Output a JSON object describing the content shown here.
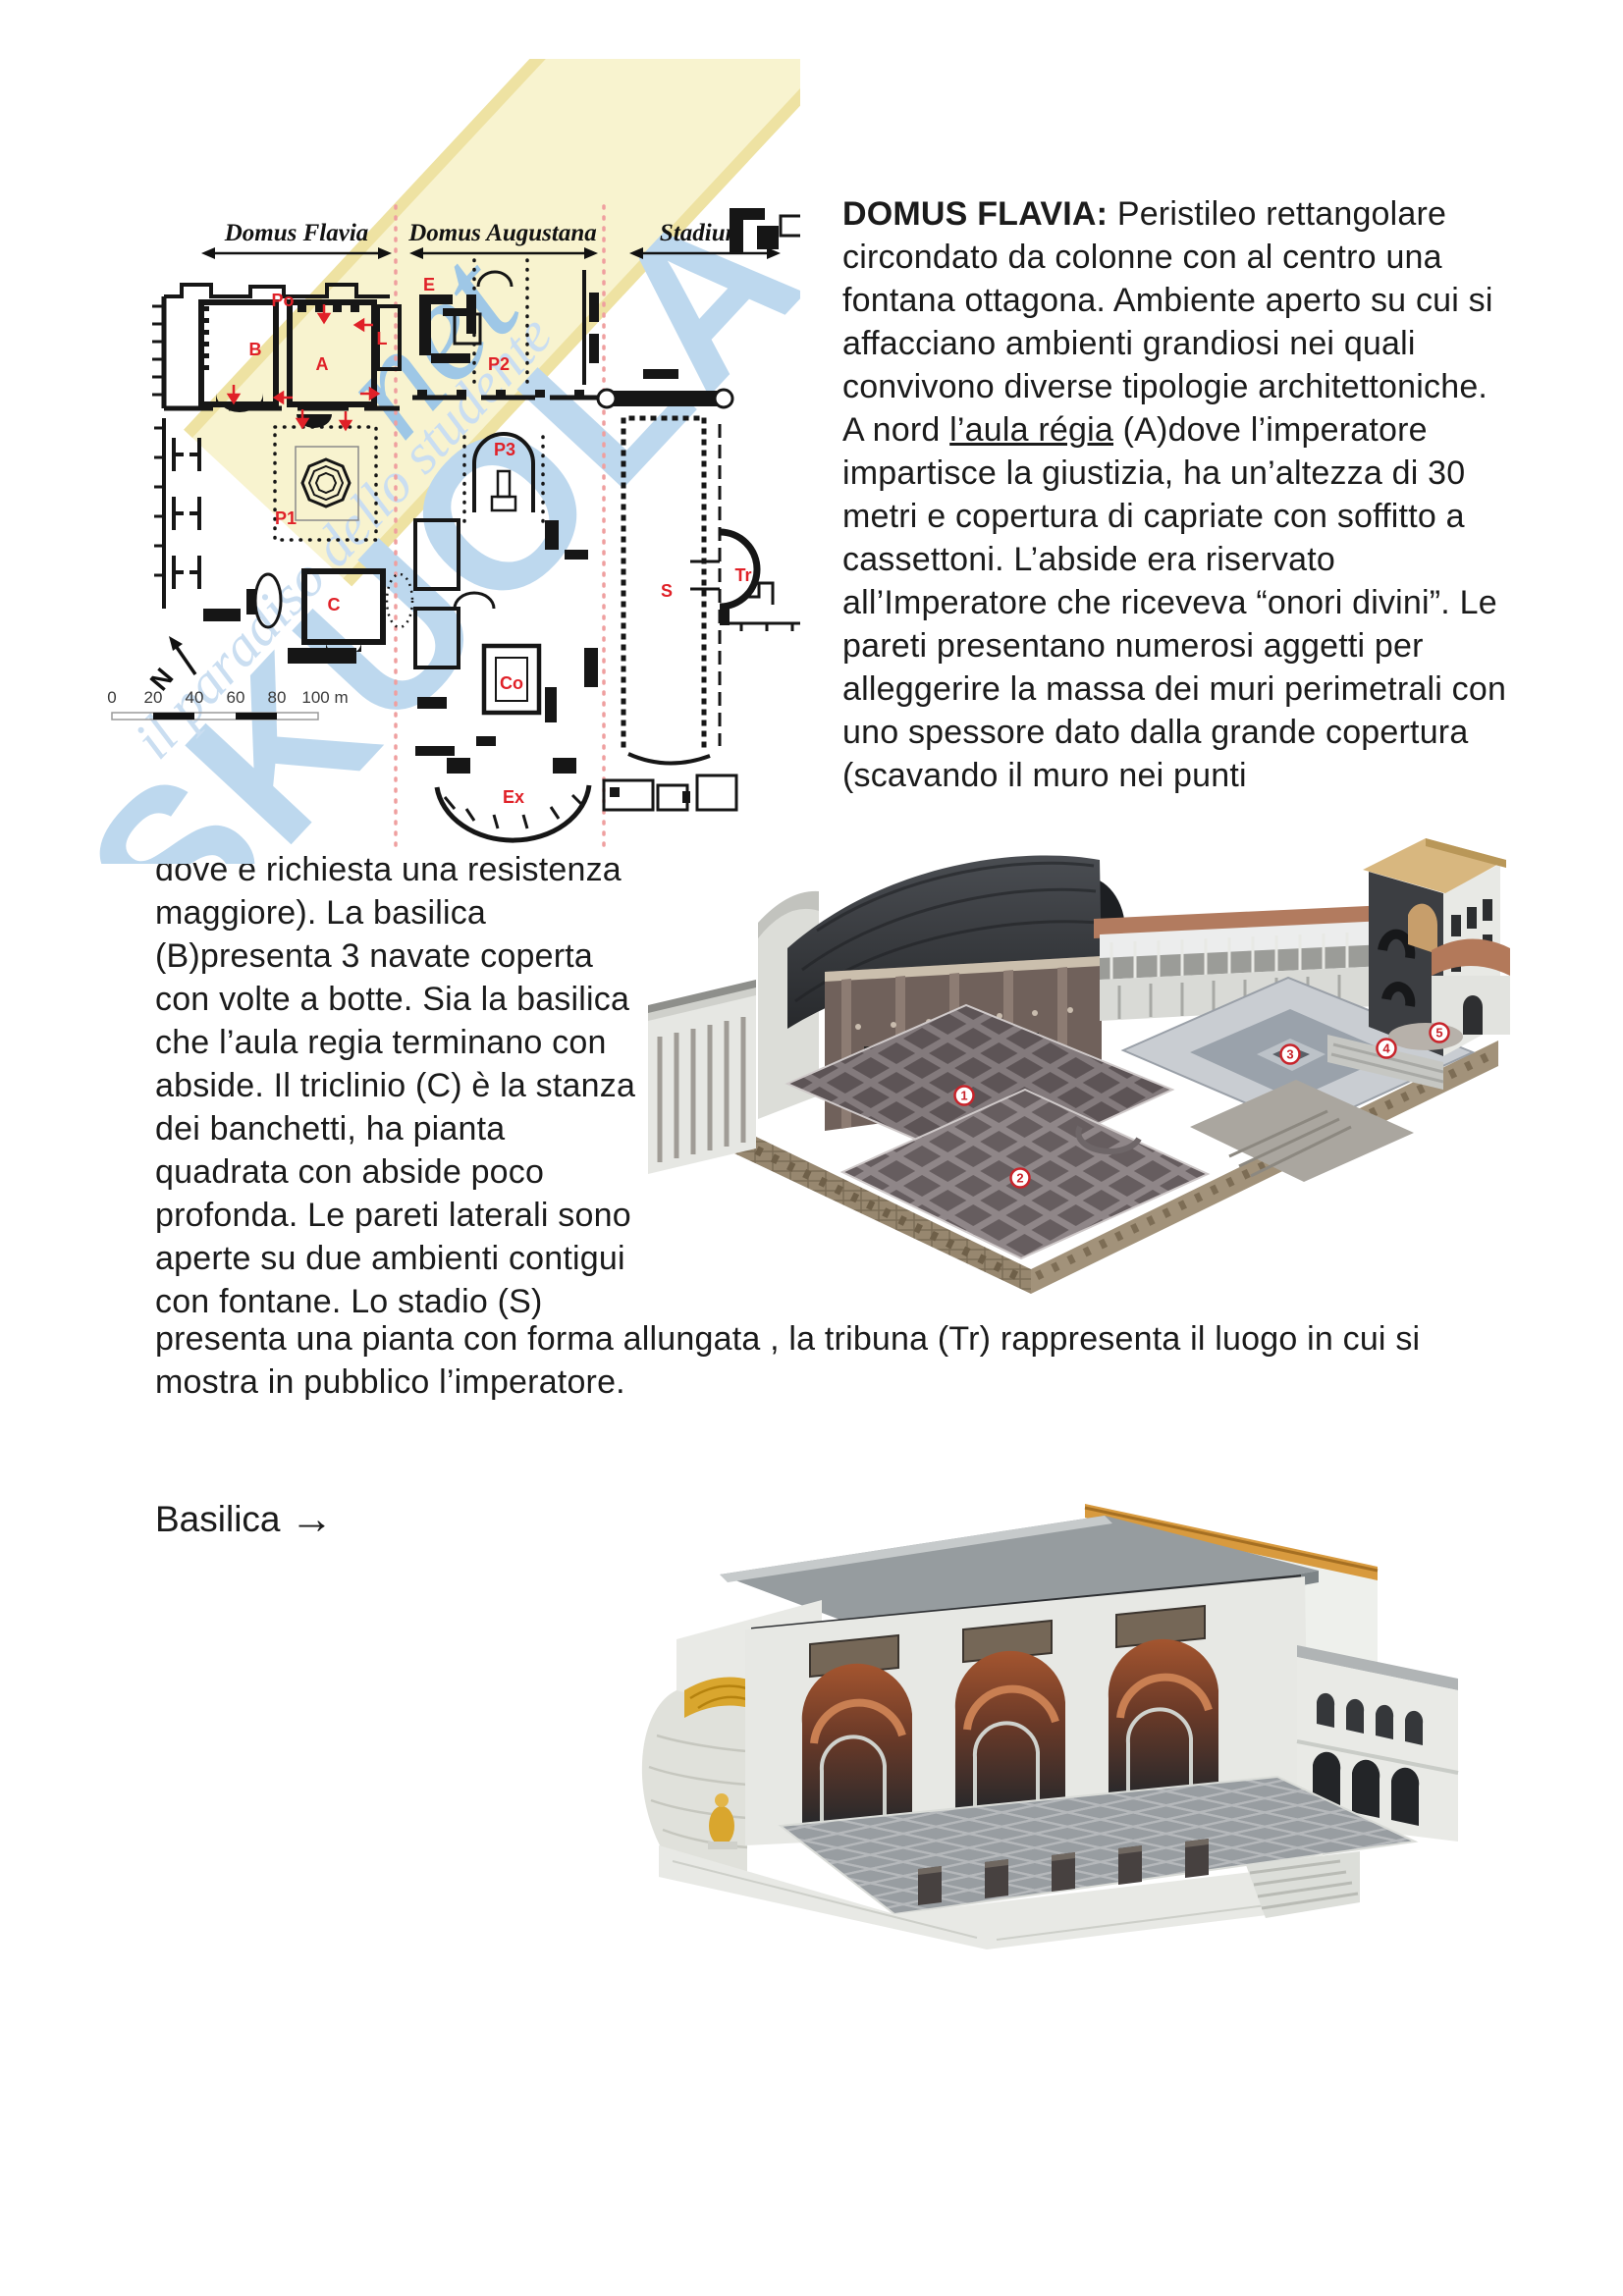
{
  "watermark": {
    "brand": "SKUOLA",
    "brand_suffix": "net",
    "tagline": "il paradiso dello studente",
    "color_blue": "#bdd8ee",
    "color_yellow": "#f8f3cf"
  },
  "plan": {
    "sections": [
      {
        "label": "Domus Flavia"
      },
      {
        "label": "Domus Augustana"
      },
      {
        "label": "Stadium"
      }
    ],
    "labels": {
      "po": "Po",
      "e": "E",
      "b": "B",
      "a": "A",
      "l": "L",
      "p2": "P2",
      "p3": "P3",
      "p1": "P1",
      "c": "C",
      "co": "Co",
      "ex": "Ex",
      "s": "S",
      "tr": "Tr"
    },
    "north_label": "N",
    "scale_ticks": [
      "0",
      "20",
      "40",
      "60",
      "80",
      "100 m"
    ],
    "label_color": "#e02128"
  },
  "text": {
    "lead": "DOMUS FLAVIA:",
    "p1_before": " Peristileo rettangolare circondato da colonne con al centro una fontana ottagona. Ambiente aperto su cui si affacciano ambienti grandiosi nei quali convivono diverse tipologie architettoniche. A nord ",
    "p1_underlined": "l’aula régia",
    "p1_after": " (A)dove l’imperatore impartisce la giustizia, ha un’altezza di 30 metri e copertura di capriate con soffitto a cassettoni. L’abside era riservato all’Imperatore che riceveva “onori divini”. Le pareti presentano numerosi aggetti per alleggerire la massa dei muri perimetrali con uno spessore dato dalla grande copertura (scavando il muro nei punti",
    "p2": "dove è richiesta una resistenza maggiore). La basilica (B)presenta 3 navate coperta con volte a botte. Sia la basilica che l’aula regia terminano con abside. Il triclinio (C) è la stanza dei banchetti, ha pianta quadrata con abside poco profonda. Le pareti laterali sono aperte su due ambienti contigui con fontane. Lo stadio (S)",
    "p3": "presenta una pianta con forma allungata , la tribuna (Tr) rappresenta il luogo in cui si mostra in pubblico l’imperatore.",
    "basilica_caption": "Basilica",
    "basilica_arrow": "→"
  },
  "render1": {
    "badges": [
      "1",
      "2",
      "3",
      "4",
      "5"
    ]
  }
}
